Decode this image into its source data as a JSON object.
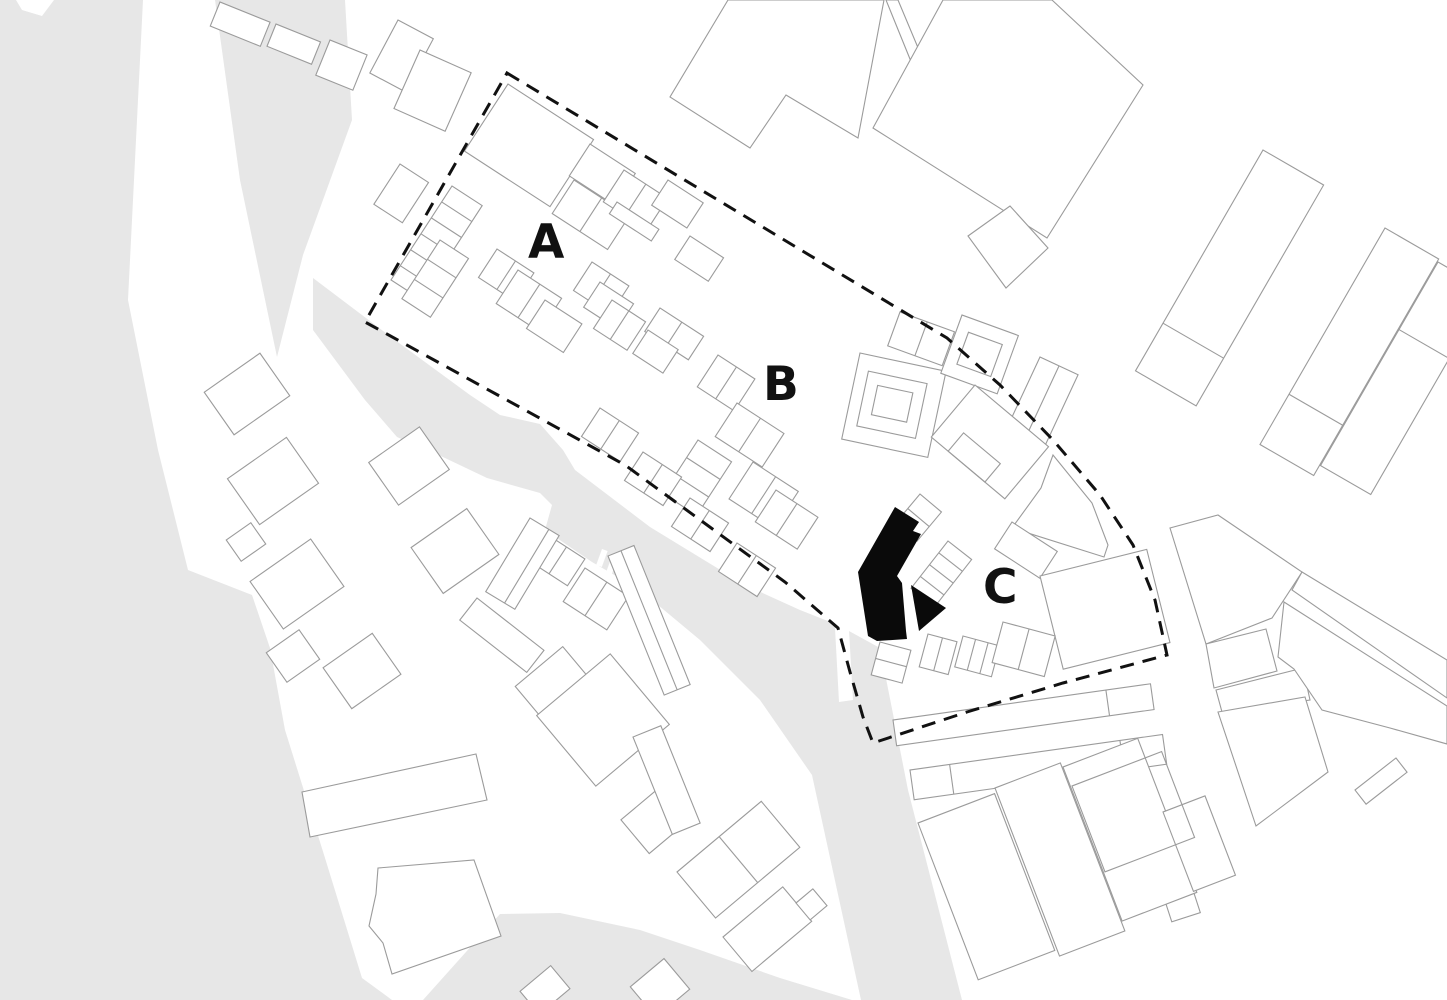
{
  "plan": {
    "kind": "architectural site plan",
    "zones": [
      {
        "id": "zone-a",
        "label": "A"
      },
      {
        "id": "zone-b",
        "label": "B"
      },
      {
        "id": "zone-c",
        "label": "C"
      }
    ]
  },
  "labels": {
    "zone_a": "A",
    "zone_b": "B",
    "zone_c": "C"
  },
  "colors": {
    "background": "#ffffff",
    "land": "#e7e7e7",
    "building_fill": "#ffffff",
    "building_stroke": "#9b9b9b",
    "site_boundary": "#111111",
    "highlight_building": "#0a0a0a",
    "label_text": "#111111"
  }
}
